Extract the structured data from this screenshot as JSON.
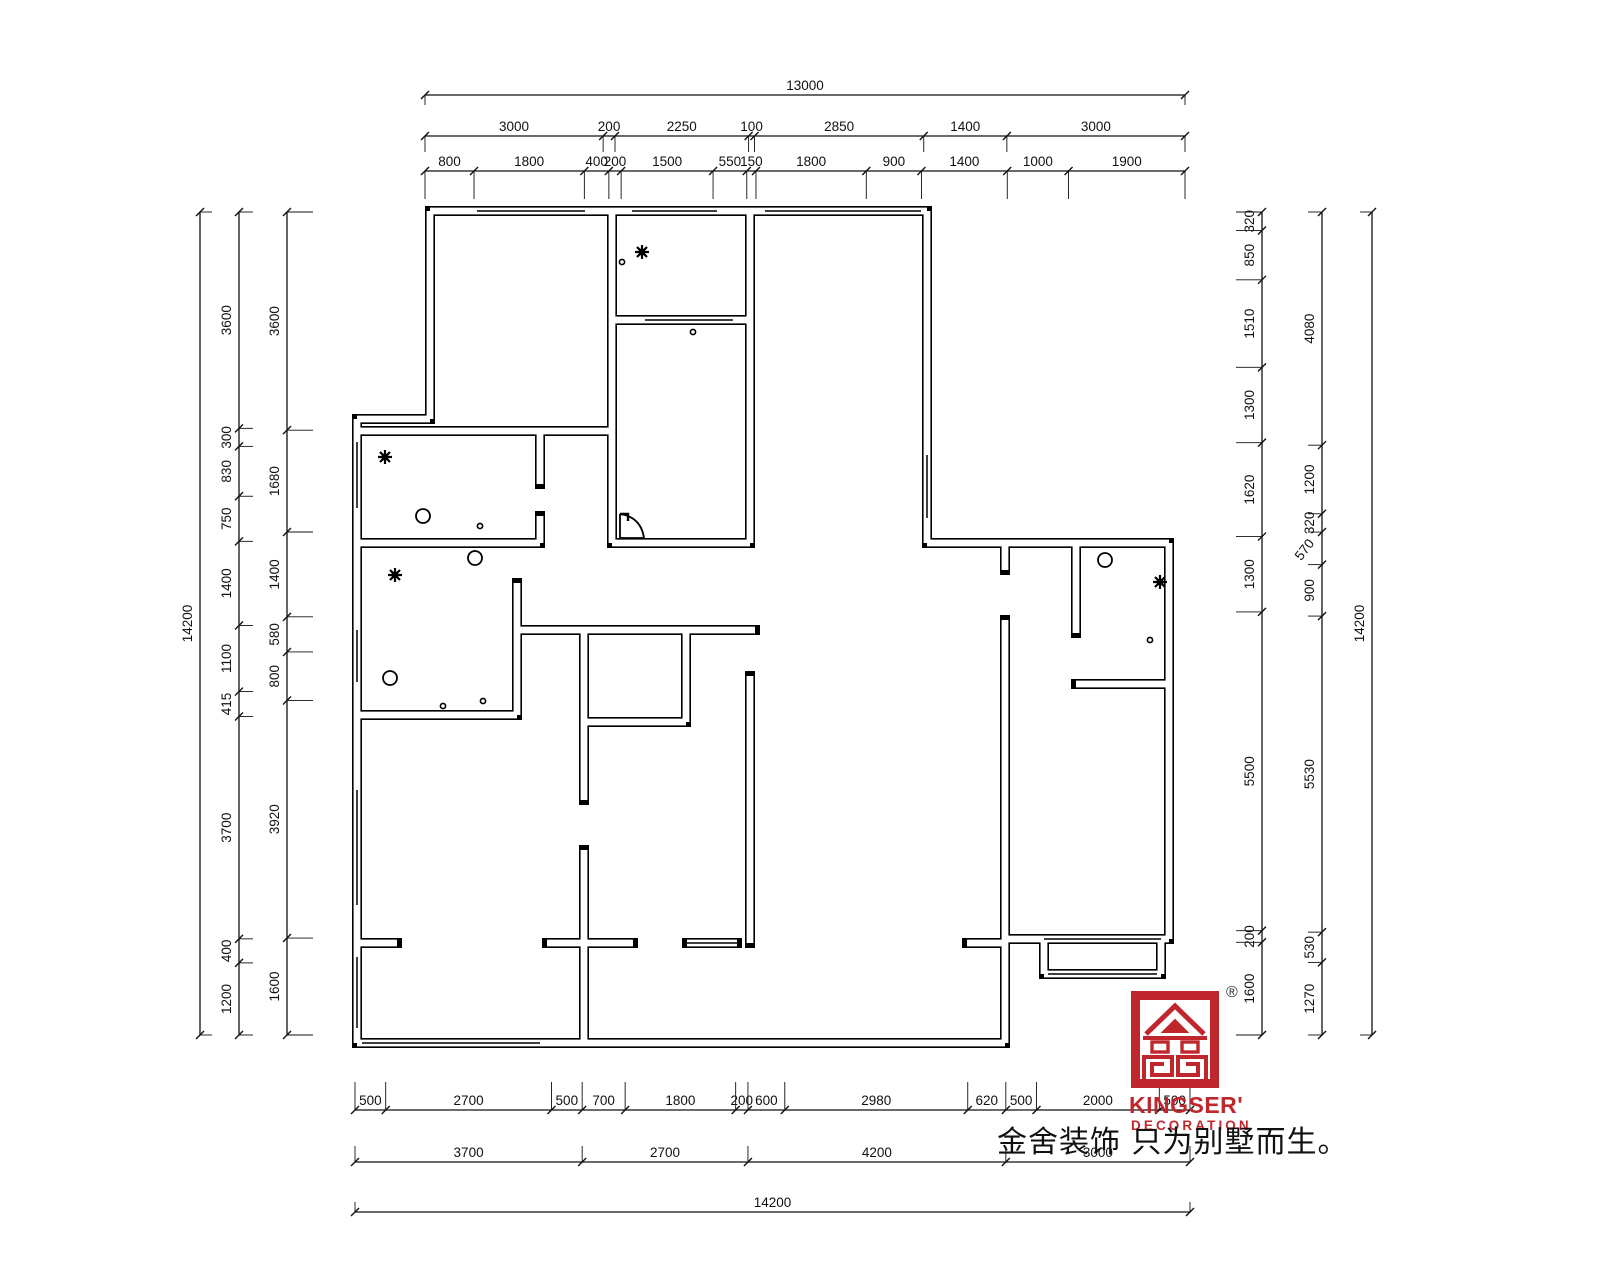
{
  "sheet": {
    "registered_mark": "®",
    "line_color": "#111111",
    "background": "#ffffff"
  },
  "logo": {
    "brand": "KINGSER'",
    "subtitle": "DECORATION",
    "color": "#c0272d"
  },
  "slogan": "金舍装饰 只为别墅而生。",
  "dimensions": {
    "top": {
      "rows": [
        [
          13000
        ],
        [
          3000,
          200,
          2250,
          100,
          2850,
          1400,
          3000
        ],
        [
          800,
          1800,
          400,
          200,
          1500,
          550,
          150,
          1800,
          900,
          1400,
          1000,
          1900
        ]
      ]
    },
    "left": {
      "columns": [
        [
          14200
        ],
        [
          3600,
          300,
          830,
          750,
          1400,
          1100,
          415,
          3700,
          400,
          1200
        ],
        [
          3600,
          1680,
          1400,
          580,
          800,
          3920,
          1600
        ]
      ]
    },
    "right": {
      "columns": [
        [
          320,
          850,
          1510,
          1300,
          1620,
          1300,
          5500,
          200,
          1600
        ],
        [
          4080,
          1200,
          320,
          570,
          900,
          5530,
          530,
          1270
        ],
        [
          14200
        ]
      ],
      "diagonal_value": 570
    },
    "bottom": {
      "rows": [
        [
          500,
          2700,
          500,
          700,
          1800,
          200,
          600,
          2980,
          620,
          500,
          2000,
          500
        ],
        [
          3700,
          2700,
          4200,
          3000
        ],
        [
          14200
        ]
      ]
    }
  }
}
